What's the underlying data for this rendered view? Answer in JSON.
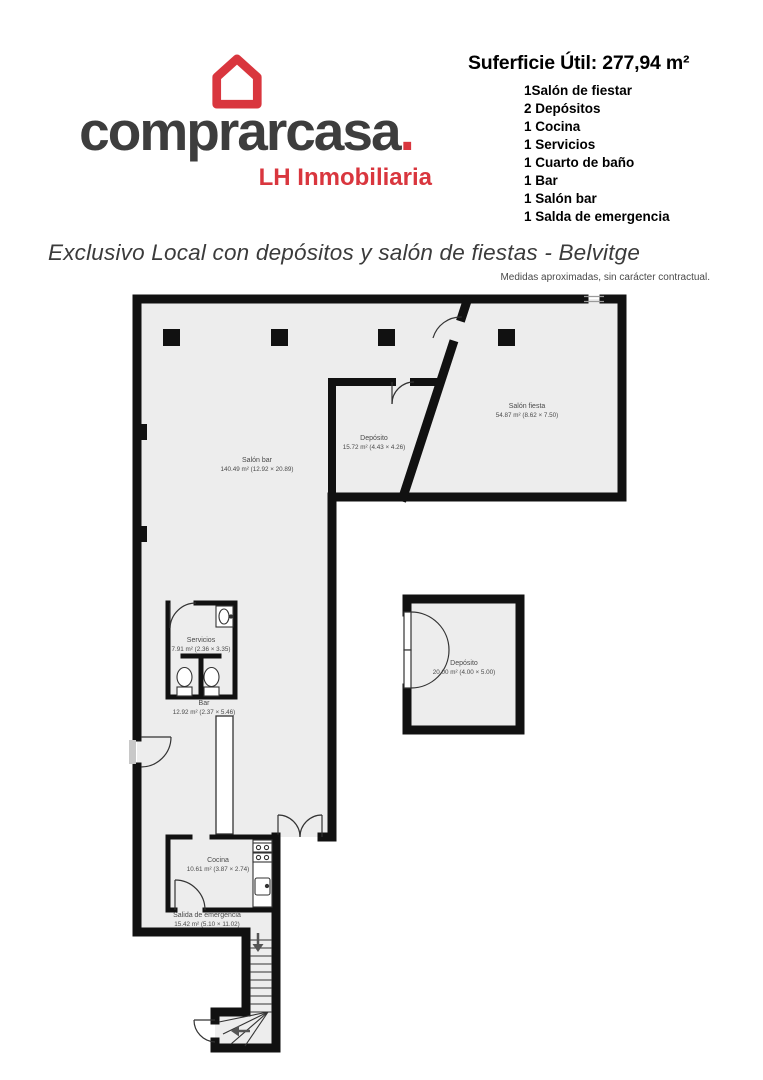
{
  "logo": {
    "brand": "comprarcasa",
    "brand_dot": ".",
    "tagline": "LH Inmobiliaria"
  },
  "summary": {
    "title": "Suferficie Útil: 277,94 m²",
    "items": [
      "1Salón de fiestar",
      "2 Depósitos",
      "1 Cocina",
      "1 Servicios",
      "1 Cuarto de baño",
      "1 Bar",
      "1 Salón bar",
      "1 Salda de emergencia"
    ]
  },
  "listing": {
    "title": "Exclusivo Local con depósitos y salón de fiestas - Belvitge",
    "disclaimer": "Medidas aproximadas, sin carácter contractual."
  },
  "floorplan": {
    "rooms": [
      {
        "name": "Salón bar",
        "dims": "140.49 m² (12.92 × 20.89)"
      },
      {
        "name": "Depósito",
        "dims": "15.72 m² (4.43 × 4.26)"
      },
      {
        "name": "Salón fiesta",
        "dims": "54.87 m² (8.62 × 7.50)"
      },
      {
        "name": "Servicios",
        "dims": "7.91 m² (2.36 × 3.35)"
      },
      {
        "name": "Bar",
        "dims": "12.92 m² (2.37 × 5.46)"
      },
      {
        "name": "Depósito",
        "dims": "20.00 m² (4.00 × 5.00)"
      },
      {
        "name": "Cocina",
        "dims": "10.61 m² (3.87 × 2.74)"
      },
      {
        "name": "Salida de emergencia",
        "dims": "15.42 m² (5.10 × 11.02)"
      }
    ]
  },
  "colors": {
    "brand_red": "#d9363e",
    "text_dark": "#3d3d3d",
    "wall_black": "#111111",
    "floor_fill": "#ededed"
  }
}
